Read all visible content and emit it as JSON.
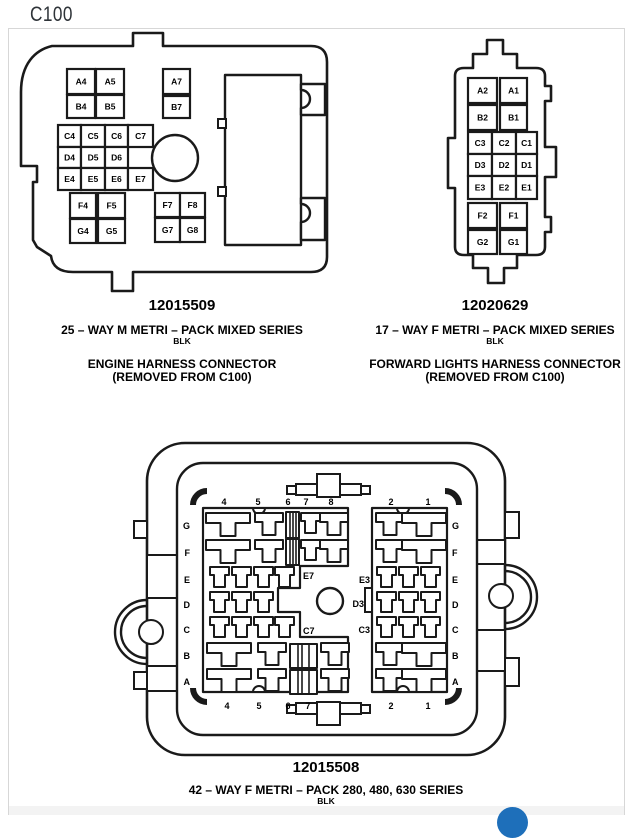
{
  "page": {
    "title": "C100"
  },
  "connector1": {
    "part_number": "12015509",
    "series": "25 – WAY M METRI – PACK MIXED SERIES",
    "color_code": "BLK",
    "caption_line1": "ENGINE HARNESS CONNECTOR",
    "caption_line2": "(REMOVED FROM C100)",
    "pins": [
      {
        "label": "A4",
        "x": 67,
        "y": 69,
        "w": 28,
        "h": 25
      },
      {
        "label": "A5",
        "x": 96,
        "y": 69,
        "w": 28,
        "h": 25
      },
      {
        "label": "A7",
        "x": 163,
        "y": 69,
        "w": 27,
        "h": 25
      },
      {
        "label": "B4",
        "x": 67,
        "y": 95,
        "w": 28,
        "h": 23
      },
      {
        "label": "B5",
        "x": 96,
        "y": 95,
        "w": 28,
        "h": 23
      },
      {
        "label": "B7",
        "x": 163,
        "y": 96,
        "w": 27,
        "h": 22
      },
      {
        "label": "C4",
        "x": 58,
        "y": 125,
        "w": 23,
        "h": 22
      },
      {
        "label": "C5",
        "x": 81,
        "y": 125,
        "w": 24,
        "h": 22
      },
      {
        "label": "C6",
        "x": 105,
        "y": 125,
        "w": 23,
        "h": 22
      },
      {
        "label": "C7",
        "x": 128,
        "y": 125,
        "w": 25,
        "h": 22
      },
      {
        "label": "D4",
        "x": 58,
        "y": 147,
        "w": 23,
        "h": 21
      },
      {
        "label": "D5",
        "x": 81,
        "y": 147,
        "w": 24,
        "h": 21
      },
      {
        "label": "D6",
        "x": 105,
        "y": 147,
        "w": 23,
        "h": 21
      },
      {
        "label": "E4",
        "x": 58,
        "y": 168,
        "w": 23,
        "h": 22
      },
      {
        "label": "E5",
        "x": 81,
        "y": 168,
        "w": 24,
        "h": 22
      },
      {
        "label": "E6",
        "x": 105,
        "y": 168,
        "w": 23,
        "h": 22
      },
      {
        "label": "E7",
        "x": 128,
        "y": 168,
        "w": 25,
        "h": 22
      },
      {
        "label": "F4",
        "x": 70,
        "y": 193,
        "w": 26,
        "h": 25
      },
      {
        "label": "F5",
        "x": 98,
        "y": 193,
        "w": 27,
        "h": 25
      },
      {
        "label": "F7",
        "x": 155,
        "y": 193,
        "w": 25,
        "h": 24
      },
      {
        "label": "F8",
        "x": 180,
        "y": 193,
        "w": 25,
        "h": 24
      },
      {
        "label": "G4",
        "x": 70,
        "y": 219,
        "w": 26,
        "h": 24
      },
      {
        "label": "G5",
        "x": 98,
        "y": 219,
        "w": 27,
        "h": 24
      },
      {
        "label": "G7",
        "x": 155,
        "y": 218,
        "w": 25,
        "h": 24
      },
      {
        "label": "G8",
        "x": 180,
        "y": 218,
        "w": 25,
        "h": 24
      }
    ]
  },
  "connector2": {
    "part_number": "12020629",
    "series": "17 – WAY F METRI – PACK MIXED SERIES",
    "color_code": "BLK",
    "caption_line1": "FORWARD LIGHTS HARNESS CONNECTOR",
    "caption_line2": "(REMOVED FROM C100)",
    "pins": [
      {
        "label": "A2",
        "x": 468,
        "y": 78,
        "w": 29,
        "h": 25
      },
      {
        "label": "A1",
        "x": 500,
        "y": 78,
        "w": 27,
        "h": 25
      },
      {
        "label": "B2",
        "x": 468,
        "y": 105,
        "w": 29,
        "h": 25
      },
      {
        "label": "B1",
        "x": 500,
        "y": 105,
        "w": 27,
        "h": 25
      },
      {
        "label": "C3",
        "x": 468,
        "y": 132,
        "w": 24,
        "h": 22
      },
      {
        "label": "C2",
        "x": 492,
        "y": 132,
        "w": 24,
        "h": 22
      },
      {
        "label": "C1",
        "x": 516,
        "y": 132,
        "w": 21,
        "h": 22
      },
      {
        "label": "D3",
        "x": 468,
        "y": 154,
        "w": 24,
        "h": 22
      },
      {
        "label": "D2",
        "x": 492,
        "y": 154,
        "w": 24,
        "h": 22
      },
      {
        "label": "D1",
        "x": 516,
        "y": 154,
        "w": 21,
        "h": 22
      },
      {
        "label": "E3",
        "x": 468,
        "y": 176,
        "w": 24,
        "h": 23
      },
      {
        "label": "E2",
        "x": 492,
        "y": 176,
        "w": 24,
        "h": 23
      },
      {
        "label": "E1",
        "x": 516,
        "y": 176,
        "w": 21,
        "h": 23
      },
      {
        "label": "F2",
        "x": 468,
        "y": 203,
        "w": 29,
        "h": 25
      },
      {
        "label": "F1",
        "x": 500,
        "y": 203,
        "w": 27,
        "h": 25
      },
      {
        "label": "G2",
        "x": 468,
        "y": 230,
        "w": 29,
        "h": 24
      },
      {
        "label": "G1",
        "x": 500,
        "y": 230,
        "w": 27,
        "h": 24
      }
    ]
  },
  "connector3": {
    "part_number": "12015508",
    "series": "42 – WAY F METRI – PACK 280, 480, 630 SERIES",
    "color_code": "BLK",
    "terminals": [
      {
        "t": "l",
        "x": 206,
        "y": 513
      },
      {
        "t": "m",
        "x": 255,
        "y": 513
      },
      {
        "t": "wn",
        "x": 286,
        "y": 512
      },
      {
        "t": "s",
        "x": 301,
        "y": 513
      },
      {
        "t": "m",
        "x": 320,
        "y": 513
      },
      {
        "t": "l",
        "x": 206,
        "y": 540
      },
      {
        "t": "m",
        "x": 255,
        "y": 540
      },
      {
        "t": "wn",
        "x": 286,
        "y": 539
      },
      {
        "t": "s",
        "x": 301,
        "y": 540
      },
      {
        "t": "m",
        "x": 320,
        "y": 540
      },
      {
        "t": "s",
        "x": 210,
        "y": 567
      },
      {
        "t": "s",
        "x": 232,
        "y": 567
      },
      {
        "t": "s",
        "x": 254,
        "y": 567
      },
      {
        "t": "s",
        "x": 275,
        "y": 567
      },
      {
        "t": "s",
        "x": 210,
        "y": 592
      },
      {
        "t": "s",
        "x": 232,
        "y": 592
      },
      {
        "t": "s",
        "x": 254,
        "y": 592
      },
      {
        "t": "s",
        "x": 210,
        "y": 617
      },
      {
        "t": "s",
        "x": 232,
        "y": 617
      },
      {
        "t": "s",
        "x": 254,
        "y": 617
      },
      {
        "t": "s",
        "x": 275,
        "y": 617
      },
      {
        "t": "l",
        "x": 207,
        "y": 643
      },
      {
        "t": "m",
        "x": 258,
        "y": 643
      },
      {
        "t": "ww",
        "x": 290,
        "y": 644
      },
      {
        "t": "m",
        "x": 321,
        "y": 643
      },
      {
        "t": "l",
        "x": 207,
        "y": 669
      },
      {
        "t": "m",
        "x": 258,
        "y": 669
      },
      {
        "t": "ww",
        "x": 290,
        "y": 670
      },
      {
        "t": "m",
        "x": 321,
        "y": 669
      },
      {
        "t": "m",
        "x": 376,
        "y": 513
      },
      {
        "t": "l",
        "x": 402,
        "y": 513
      },
      {
        "t": "m",
        "x": 376,
        "y": 540
      },
      {
        "t": "l",
        "x": 402,
        "y": 540
      },
      {
        "t": "s",
        "x": 377,
        "y": 567
      },
      {
        "t": "s",
        "x": 399,
        "y": 567
      },
      {
        "t": "s",
        "x": 421,
        "y": 567
      },
      {
        "t": "s",
        "x": 377,
        "y": 592
      },
      {
        "t": "s",
        "x": 399,
        "y": 592
      },
      {
        "t": "s",
        "x": 421,
        "y": 592
      },
      {
        "t": "s",
        "x": 377,
        "y": 617
      },
      {
        "t": "s",
        "x": 399,
        "y": 617
      },
      {
        "t": "s",
        "x": 421,
        "y": 617
      },
      {
        "t": "m",
        "x": 376,
        "y": 643
      },
      {
        "t": "l",
        "x": 402,
        "y": 643
      },
      {
        "t": "m",
        "x": 376,
        "y": 669
      },
      {
        "t": "l",
        "x": 402,
        "y": 669
      }
    ],
    "labels": [
      {
        "text": "G",
        "x": 190,
        "y": 529,
        "a": "end"
      },
      {
        "text": "F",
        "x": 190,
        "y": 556,
        "a": "end"
      },
      {
        "text": "E",
        "x": 190,
        "y": 583,
        "a": "end"
      },
      {
        "text": "D",
        "x": 190,
        "y": 608,
        "a": "end"
      },
      {
        "text": "C",
        "x": 190,
        "y": 633,
        "a": "end"
      },
      {
        "text": "B",
        "x": 190,
        "y": 659,
        "a": "end"
      },
      {
        "text": "A",
        "x": 190,
        "y": 685,
        "a": "end"
      },
      {
        "text": "G",
        "x": 452,
        "y": 529,
        "a": "start"
      },
      {
        "text": "F",
        "x": 452,
        "y": 556,
        "a": "start"
      },
      {
        "text": "E",
        "x": 452,
        "y": 583,
        "a": "start"
      },
      {
        "text": "D",
        "x": 452,
        "y": 608,
        "a": "start"
      },
      {
        "text": "C",
        "x": 452,
        "y": 633,
        "a": "start"
      },
      {
        "text": "B",
        "x": 452,
        "y": 659,
        "a": "start"
      },
      {
        "text": "A",
        "x": 452,
        "y": 685,
        "a": "start"
      },
      {
        "text": "4",
        "x": 224,
        "y": 505,
        "a": "middle"
      },
      {
        "text": "5",
        "x": 258,
        "y": 505,
        "a": "middle"
      },
      {
        "text": "6",
        "x": 288,
        "y": 505,
        "a": "middle"
      },
      {
        "text": "7",
        "x": 306,
        "y": 505,
        "a": "middle"
      },
      {
        "text": "8",
        "x": 331,
        "y": 505,
        "a": "middle"
      },
      {
        "text": "2",
        "x": 391,
        "y": 505,
        "a": "middle"
      },
      {
        "text": "1",
        "x": 428,
        "y": 505,
        "a": "middle"
      },
      {
        "text": "4",
        "x": 227,
        "y": 709,
        "a": "middle"
      },
      {
        "text": "5",
        "x": 259,
        "y": 709,
        "a": "middle"
      },
      {
        "text": "6",
        "x": 288,
        "y": 709,
        "a": "middle"
      },
      {
        "text": "7",
        "x": 308,
        "y": 709,
        "a": "middle"
      },
      {
        "text": "2",
        "x": 391,
        "y": 709,
        "a": "middle"
      },
      {
        "text": "1",
        "x": 428,
        "y": 709,
        "a": "middle"
      },
      {
        "text": "E7",
        "x": 303,
        "y": 579,
        "a": "start"
      },
      {
        "text": "C7",
        "x": 303,
        "y": 634,
        "a": "start"
      },
      {
        "text": "E3",
        "x": 370,
        "y": 583,
        "a": "end"
      },
      {
        "text": "D3",
        "x": 364,
        "y": 607,
        "a": "end"
      },
      {
        "text": "C3",
        "x": 370,
        "y": 633,
        "a": "end"
      }
    ]
  },
  "colors": {
    "line": "#1a1a1a",
    "accent_blue": "#1e6fba",
    "panel_border": "#d7d7d7"
  }
}
